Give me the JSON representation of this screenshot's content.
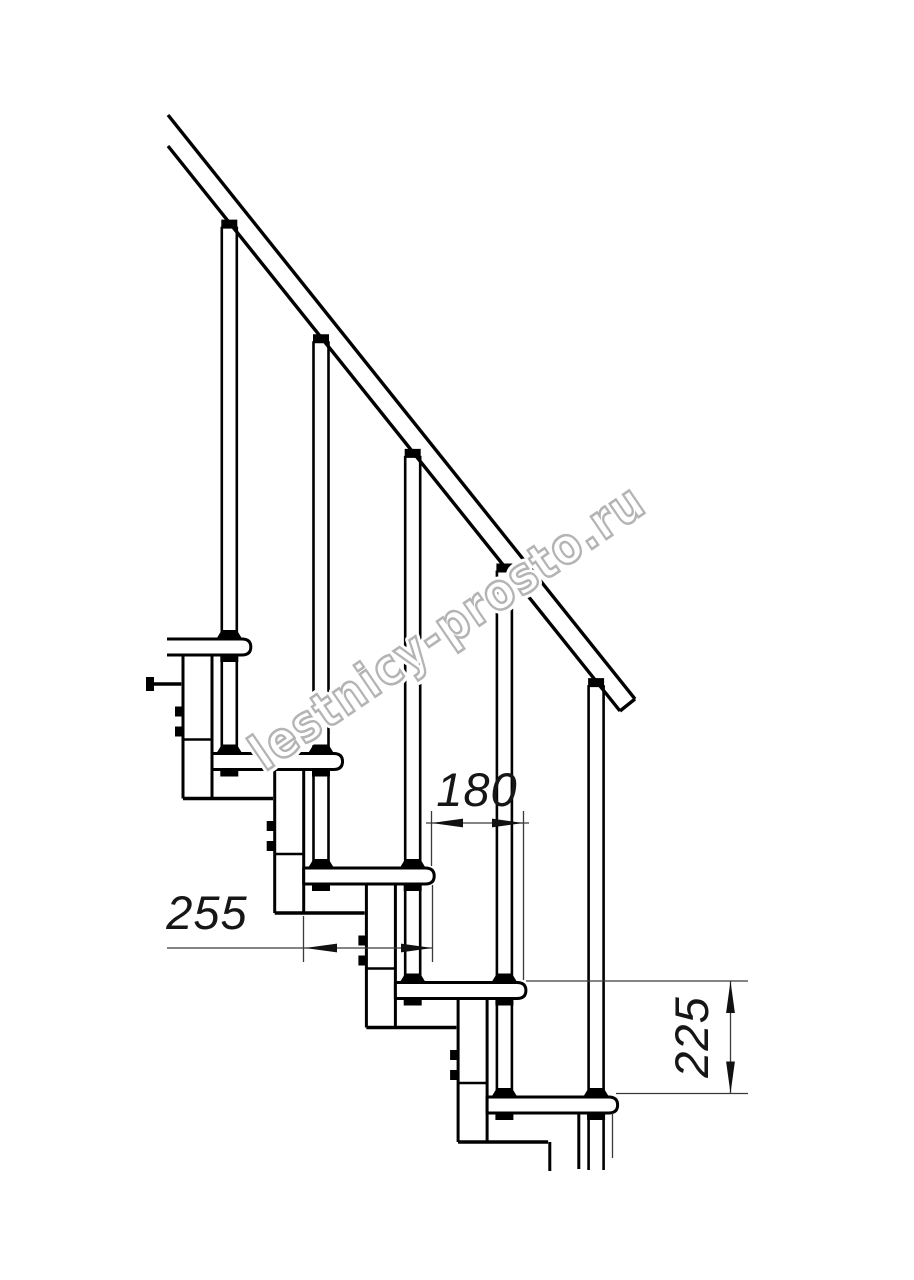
{
  "page": {
    "background": "#ffffff"
  },
  "drawing": {
    "watermark": "lestnicy-prosto.ru",
    "line_color": "#000000",
    "dimension_line_color": "#3a3a3a",
    "watermark_color": "#b4b4b4",
    "dimensions": {
      "step_overlap_label": "180",
      "tread_depth_label": "255",
      "rise_label": "225"
    }
  }
}
